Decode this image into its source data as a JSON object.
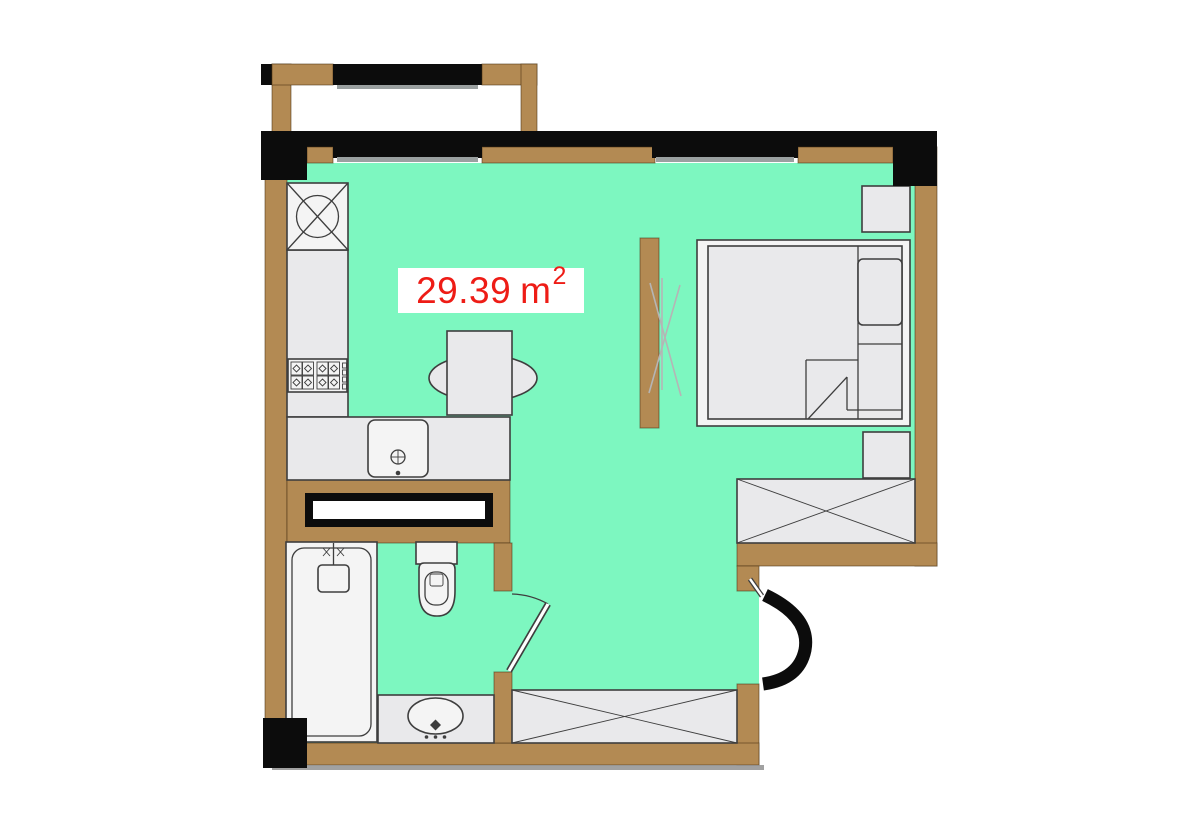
{
  "plan": {
    "area_label": {
      "value": "29.39",
      "unit": "m",
      "superscript": "2"
    },
    "colors": {
      "floor": "#7df7c0",
      "wall": "#b38a53",
      "ink": "#0c0c0c",
      "furniture-fill": "#e9e9eb",
      "furniture-fill-light": "#f4f4f4",
      "furniture-stroke": "#3e3e3e",
      "sill-gray": "#9aa0a0",
      "shadow-gray": "#8a8a8a",
      "partition-line": "#b5b5b5",
      "label-red": "#ee1c16",
      "label-bg": "#ffffff"
    },
    "symbols": [
      "balcony",
      "window",
      "refrigerator",
      "gas-stove",
      "kitchen-sink",
      "kitchen-counter",
      "dining-table",
      "chairs",
      "double-bed",
      "pillow",
      "nightstand",
      "sliding-partition",
      "wardrobe",
      "bathtub",
      "shower-mixer",
      "toilet",
      "washbasin",
      "vanity",
      "bathroom-door",
      "entry-door"
    ]
  }
}
